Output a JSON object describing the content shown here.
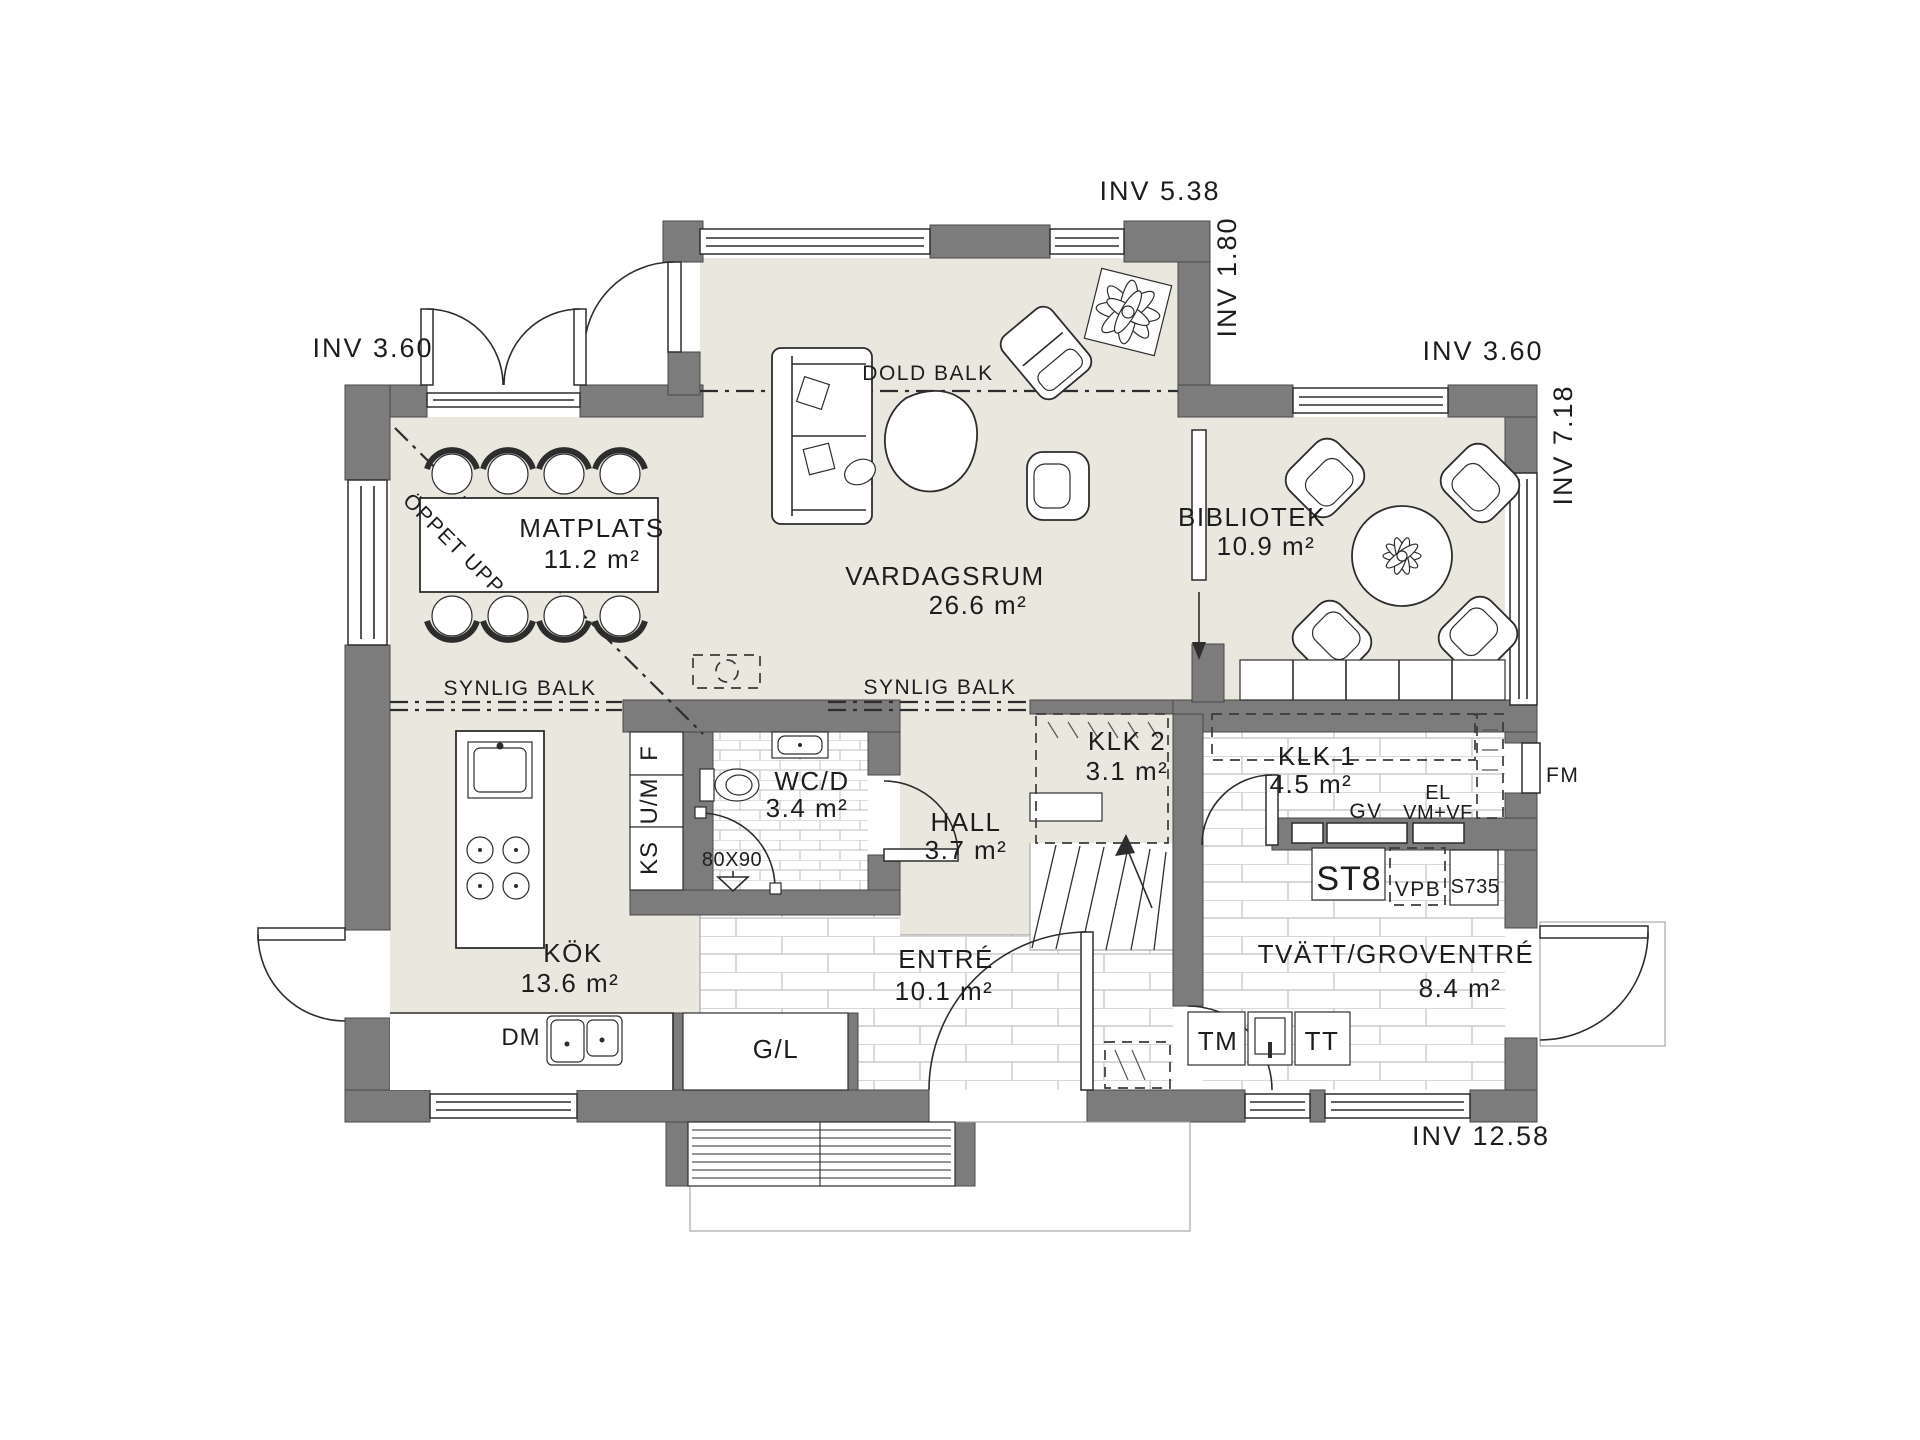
{
  "colors": {
    "wall": "#7c7c7c",
    "floor_living": "#e9e7de",
    "floor_tile": "#ffffff",
    "tile_joint": "#cccccc",
    "line": "#2d2d2d",
    "text": "#1d1d1d"
  },
  "rooms": {
    "matplats": {
      "name": "MATPLATS",
      "area": "11.2 m²"
    },
    "vardagsrum": {
      "name": "VARDAGSRUM",
      "area": "26.6 m²"
    },
    "bibliotek": {
      "name": "BIBLIOTEK",
      "area": "10.9 m²"
    },
    "kok": {
      "name": "KÖK",
      "area": "13.6 m²"
    },
    "wc": {
      "name": "WC/D",
      "area": "3.4 m²"
    },
    "hall": {
      "name": "HALL",
      "area": "3.7 m²"
    },
    "klk2": {
      "name": "KLK 2",
      "area": "3.1 m²"
    },
    "klk1": {
      "name": "KLK 1",
      "area": "4.5 m²"
    },
    "entre": {
      "name": "ENTRÉ",
      "area": "10.1 m²"
    },
    "tvatt": {
      "name": "TVÄTT/GROVENTRÉ",
      "area": "8.4 m²"
    }
  },
  "dimensions": {
    "top": "INV 5.38",
    "top_right": "INV 1.80",
    "left": "INV 3.60",
    "right_upper": "INV 3.60",
    "right_side": "INV 7.18",
    "bottom": "INV 12.58"
  },
  "beams": {
    "dold": "DOLD BALK",
    "synlig_left": "SYNLIG BALK",
    "synlig_right": "SYNLIG BALK"
  },
  "annotations": {
    "open_above": "ÖPPET UPP",
    "shower_size": "80X90"
  },
  "appliances": {
    "f": "F",
    "um": "U/M",
    "ks": "KS",
    "dm": "DM",
    "gl": "G/L",
    "tm": "TM",
    "tt": "TT",
    "st8": "ST8",
    "vpb": "VPB",
    "s735": "S735",
    "gv": "GV",
    "el": "EL",
    "vmvf": "VM+VF",
    "fm": "FM"
  }
}
